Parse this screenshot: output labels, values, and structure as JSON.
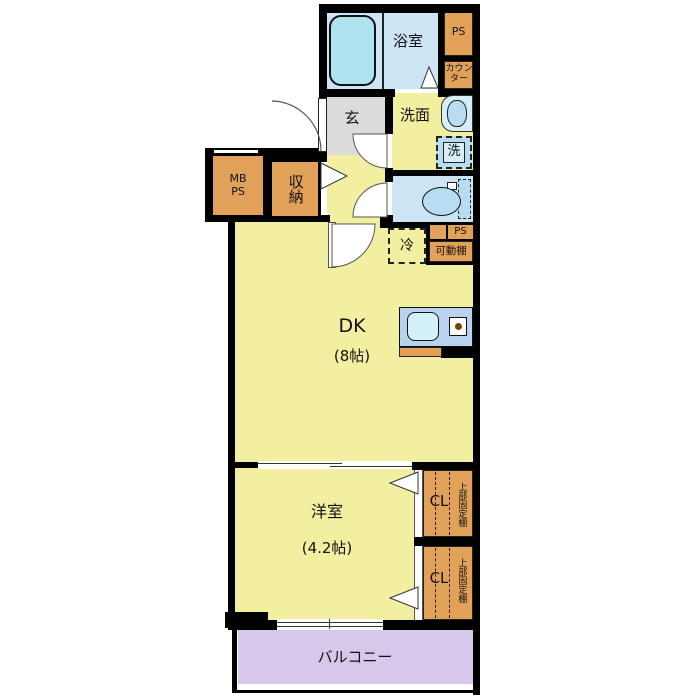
{
  "plan_title": "1DK apartment floor plan",
  "rooms": {
    "bathroom": {
      "label": "浴室"
    },
    "washroom": {
      "label": "洗面"
    },
    "entrance": {
      "label": "玄"
    },
    "storage": {
      "label": "収納"
    },
    "meter_box": {
      "line1": "MB",
      "line2": "PS"
    },
    "pipe_shaft_top": {
      "label": "PS"
    },
    "counter": {
      "label": "カウンター"
    },
    "pipe_shaft_mid": {
      "label": "PS"
    },
    "movable_shelf": {
      "label": "可動棚"
    },
    "refrigerator": {
      "label": "冷"
    },
    "washing_machine": {
      "label": "洗"
    },
    "dining_kitchen": {
      "label": "DK",
      "size": "(8帖)"
    },
    "western_room": {
      "label": "洋室",
      "size": "(4.2帖)"
    },
    "closet_upper": {
      "label": "CL",
      "shelf": "上部固定棚"
    },
    "closet_lower": {
      "label": "CL",
      "shelf": "上部固定棚"
    },
    "balcony": {
      "label": "バルコニー"
    }
  },
  "colors": {
    "wall": "#000000",
    "room-yellow": "#F3EFA1",
    "orange": "#E2A159",
    "gray": "#DBDBDB",
    "blue-room": "#CDE4F4",
    "tub": "#AEE2EF",
    "fixture-blue": "#B8DCF2",
    "fixture-light": "#D6EEF8",
    "balcony-purple": "#D5C8EB",
    "counter-blue": "#B9D3EC",
    "sink-cyan": "#D2F2F7",
    "burner-dot": "#7B3F00",
    "door-stroke": "#555555"
  }
}
